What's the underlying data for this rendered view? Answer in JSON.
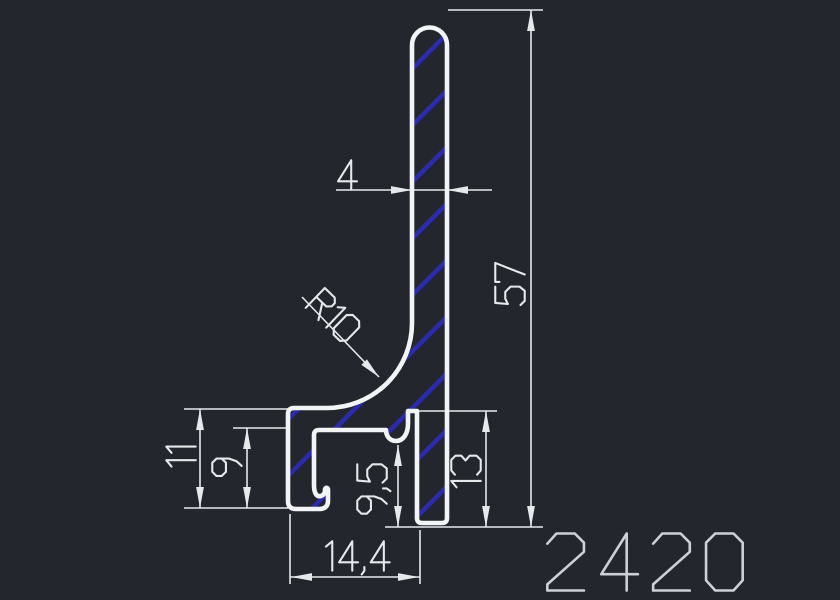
{
  "title": "Aluminium profile cross-section CAD drawing",
  "part_number": "2420",
  "colors": {
    "background": "#23262d",
    "outline": "#f2f4f6",
    "dimension": "#e6e8eb",
    "hatch": "#2b2bb0",
    "part_number_text": "#ccd0d7"
  },
  "dimensions": {
    "stem_width": {
      "label": "4",
      "meaning": "stem thickness"
    },
    "overall_height": {
      "label": "57",
      "meaning": "overall height"
    },
    "fillet_radius": {
      "label": "R10",
      "meaning": "fillet radius"
    },
    "foot_outer_height": {
      "label": "11",
      "meaning": "foot outer height"
    },
    "foot_inner_height": {
      "label": "9",
      "meaning": "foot channel inner height"
    },
    "hook_to_bottom": {
      "label": "9,5",
      "meaning": "drip hook to bottom"
    },
    "flange_to_bottom": {
      "label": "13",
      "meaning": "flange top to bottom"
    },
    "foot_width": {
      "label": "14,4",
      "meaning": "foot width"
    }
  }
}
